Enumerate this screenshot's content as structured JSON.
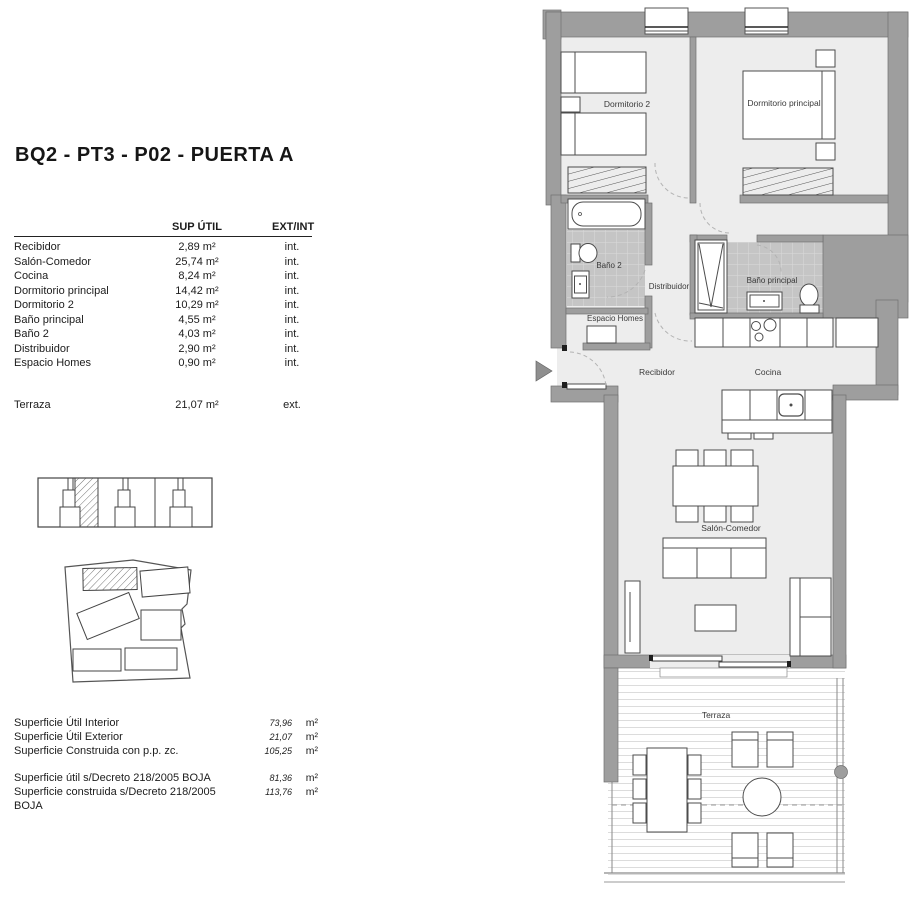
{
  "title": "BQ2 - PT3 - P02 - PUERTA A",
  "area_table": {
    "headers": {
      "col_area": "SUP ÚTIL",
      "col_location": "EXT/INT"
    },
    "rows": [
      {
        "name": "Recibidor",
        "area": "2,89 m²",
        "loc": "int."
      },
      {
        "name": "Salón-Comedor",
        "area": "25,74 m²",
        "loc": "int."
      },
      {
        "name": "Cocina",
        "area": "8,24 m²",
        "loc": "int."
      },
      {
        "name": "Dormitorio principal",
        "area": "14,42 m²",
        "loc": "int."
      },
      {
        "name": "Dormitorio 2",
        "area": "10,29 m²",
        "loc": "int."
      },
      {
        "name": "Baño principal",
        "area": "4,55 m²",
        "loc": "int."
      },
      {
        "name": "Baño 2",
        "area": "4,03 m²",
        "loc": "int."
      },
      {
        "name": "Distribuidor",
        "area": "2,90 m²",
        "loc": "int."
      },
      {
        "name": "Espacio Homes",
        "area": "0,90 m²",
        "loc": "int."
      }
    ],
    "exterior_row": {
      "name": "Terraza",
      "area": "21,07 m²",
      "loc": "ext."
    }
  },
  "summary": {
    "rows": [
      {
        "label": "Superficie Útil Interior",
        "value": "73,96",
        "unit": "m²"
      },
      {
        "label": "Superficie Útil Exterior",
        "value": "21,07",
        "unit": "m²"
      },
      {
        "label": "Superficie Construida con p.p. zc.",
        "value": "105,25",
        "unit": "m²"
      }
    ],
    "rows2": [
      {
        "label": "Superficie útil s/Decreto 218/2005 BOJA",
        "value": "81,36",
        "unit": "m²"
      },
      {
        "label": "Superficie construida s/Decreto 218/2005 BOJA",
        "value": "113,76",
        "unit": "m²"
      }
    ]
  },
  "floorplan": {
    "labels": {
      "dormitorio2": "Dormitorio 2",
      "dormitorio_principal": "Dormitorio principal",
      "bano2": "Baño 2",
      "distribuidor": "Distribuidor",
      "bano_principal": "Baño principal",
      "espacio_homes": "Espacio Homes",
      "recibidor": "Recibidor",
      "cocina": "Cocina",
      "salon_comedor": "Salón-Comedor",
      "terraza": "Terraza"
    }
  },
  "colors": {
    "wall": "#9e9e9e",
    "floor": "#ededed",
    "bath_tile": "#c5c5c5",
    "deck_line": "#dcdcdc",
    "line": "#4c4c4c",
    "text": "#3a3a3a"
  }
}
